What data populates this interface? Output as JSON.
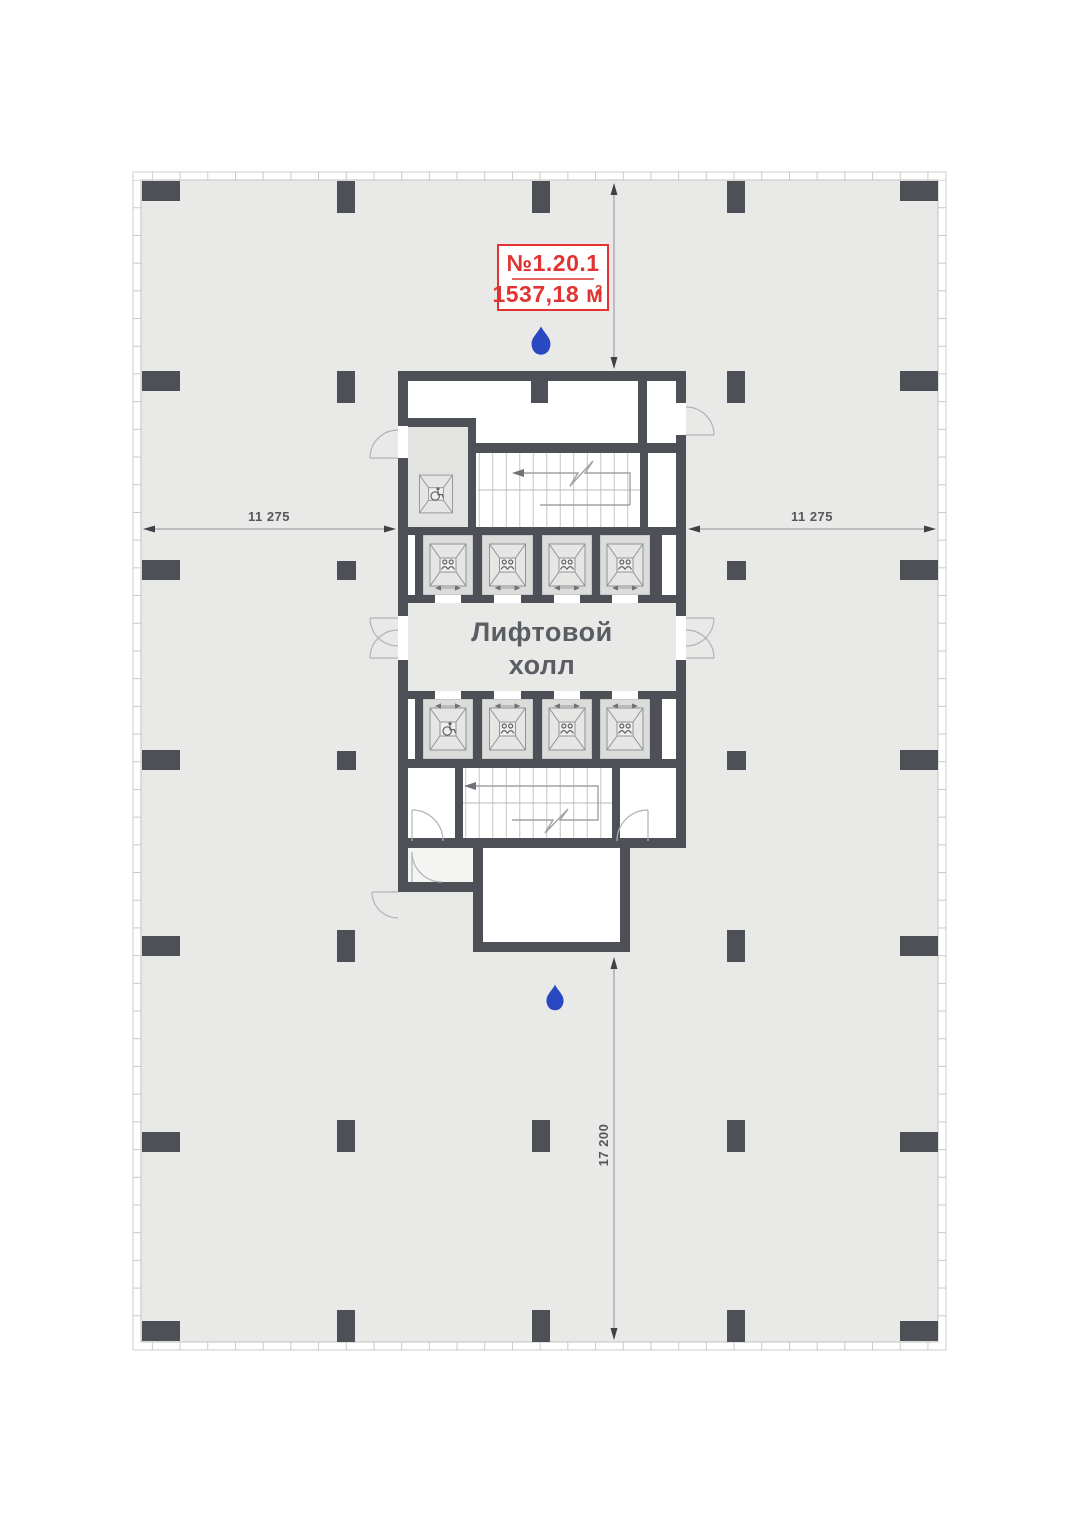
{
  "unit": {
    "number": "№1.20.1",
    "area_main": "1537,18 м",
    "area_sup": "2"
  },
  "hall": {
    "line1": "Лифтовой",
    "line2": "холл"
  },
  "dims": {
    "v_top": "8 400",
    "v_bottom": "17 200",
    "h_left": "11 275",
    "h_right": "11 275"
  },
  "colors": {
    "wall": "#4d5057",
    "floor": "#e9e9e7",
    "shaft": "#dcdcdb",
    "accent_red": "#e13331",
    "drop_blue": "#2948c1",
    "dim_line": "#909094",
    "label_text": "#5a5d63"
  },
  "icons": [
    "water-drop-icon",
    "people-icon",
    "wheelchair-icon",
    "stair-arrow-icon"
  ]
}
